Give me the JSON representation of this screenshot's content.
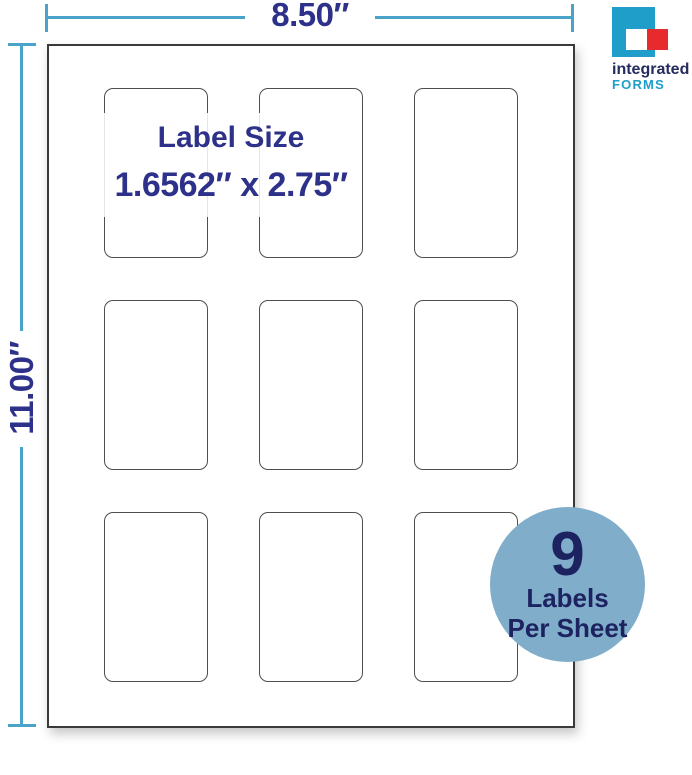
{
  "colors": {
    "dimension_line": "#4aa3c8",
    "navy": "#2d3189",
    "sheet_border": "#3a3a3a",
    "label_border": "#4f4f4f",
    "badge_fill": "#7fadca",
    "badge_text": "#1d2361",
    "logo_blue": "#1e9ec8",
    "logo_red": "#e62a2e",
    "logo_navy": "#252a5f"
  },
  "dimensions": {
    "width_label": "8.50″",
    "height_label": "11.00″"
  },
  "sheet": {
    "rows": 3,
    "cols": 3,
    "labels_count": 9
  },
  "callout": {
    "title": "Label Size",
    "size_text": "1.6562″ x 2.75″"
  },
  "badge": {
    "count": "9",
    "line1": "Labels",
    "line2": "Per Sheet"
  },
  "logo": {
    "line1": "integrated",
    "line2": "FORMS"
  }
}
